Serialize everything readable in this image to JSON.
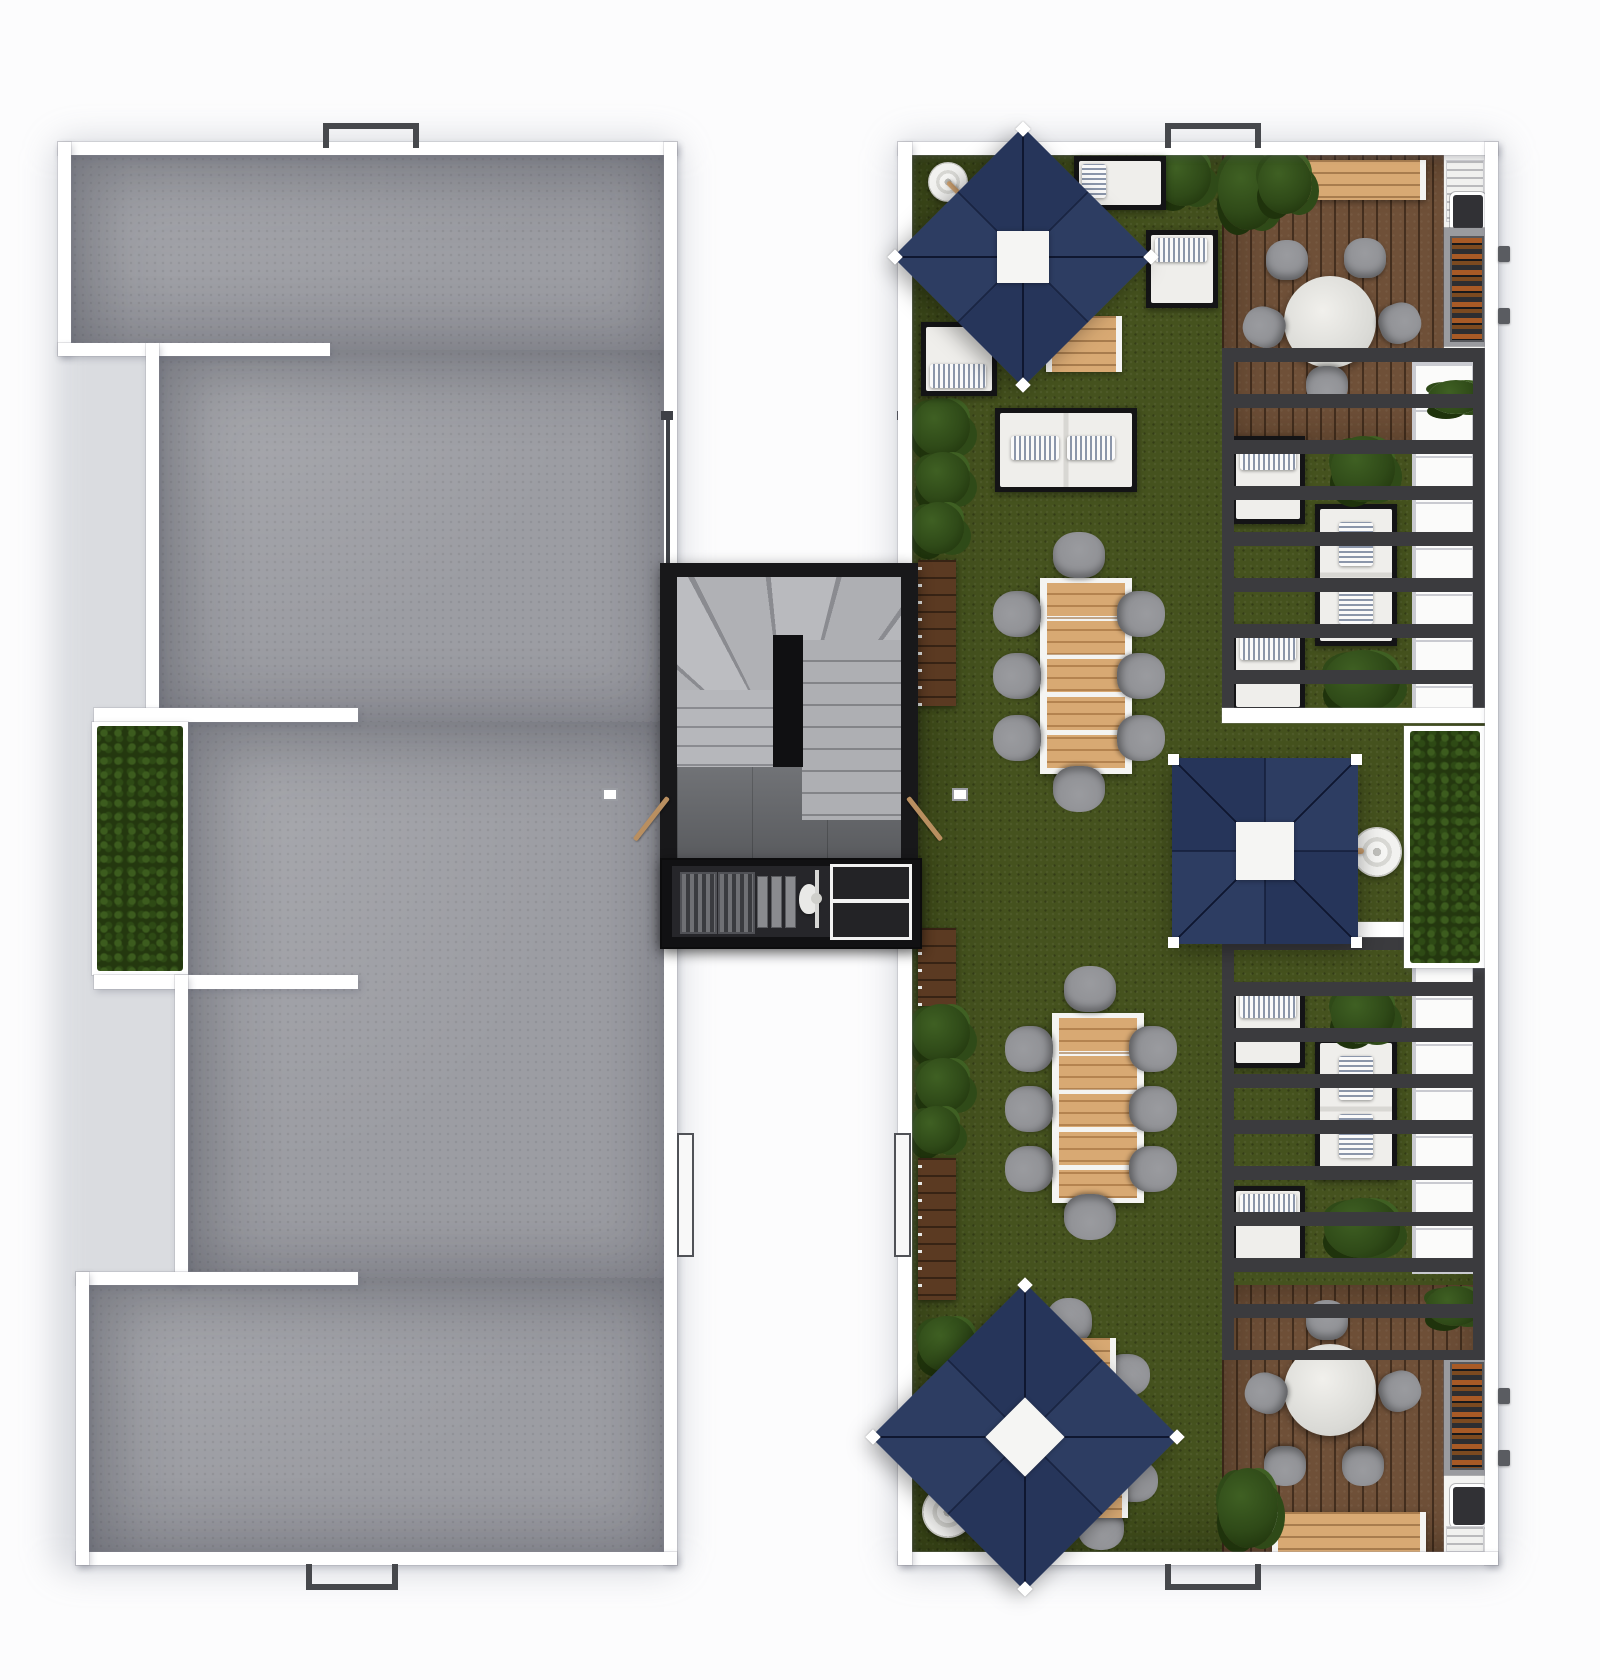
{
  "scene": {
    "type": "architectural-floorplan",
    "subject": "Rooftop terrace level - top-down 3D rendered plan",
    "view": "top-down",
    "background": "#fcfcfd",
    "buildings": [
      {
        "name": "west-roof",
        "description": "Bare concrete roof deck with stepped west facade, a hedge planter recess and roof hatch markers"
      },
      {
        "name": "east-terrace",
        "description": "Landscaped roof terrace with artificial lawn, two pergola lounges, two timber decks with round dining tables and outdoor kitchens, two 8-seat dining tables and three navy patio umbrellas"
      }
    ],
    "connector": "Central stair core with winder staircase, double access doors and a barbecue counter bridging the two roofs, flanked by open light wells with guard railings"
  },
  "palette": {
    "bg": "#fcfcfd",
    "wall": "#ffffff",
    "wall_line": "#c9cad0",
    "concrete": "#9c9da3",
    "grass": "#45521e",
    "shrub_bg": "#24380f",
    "shrub_dot": "#3c5c1e",
    "leaf": "#2f4a18",
    "leaf_hi": "#3f6023",
    "leaf_dk": "#1f330c",
    "deck": "#6f5038",
    "wood_light": "#d8a973",
    "bench_dark": "#5b3a22",
    "navy": "#2d3d62",
    "navy_dark": "#26355a",
    "seam": "#0f1730",
    "pergola": "#3b3b3e",
    "chair": "#8f9094",
    "chair_dark": "#7b7c80",
    "cushion": "#efeeeb",
    "pillow_stripe": "#8b96aa",
    "frame": "#141416",
    "stair_wall": "#18181a",
    "tread": "#b6b7bb",
    "tread_line": "#8a8b90",
    "landing": "#686a6e",
    "counter_white": "#f4f4f2",
    "steel": "#9a9b9f",
    "grill_dark": "#2e2e31",
    "skewer": "#a85a26",
    "hatch": "#46484c",
    "railing": "#3e4046",
    "door_wood": "#b98f60",
    "ring_gray": "#d8d8d4"
  },
  "inventory": {
    "navy_umbrellas": 3,
    "cantilever_umbrella_bases": 3,
    "eight_seat_dining_sets": 2,
    "round_table_five_seat_sets": 2,
    "loose_bistro_chairs": 4,
    "lounge_chairs": 7,
    "outdoor_sofas": 3,
    "dark_wood_wall_benches": 3,
    "light_wood_benches": 2,
    "hedge_planters": 2,
    "plant_clusters": 12,
    "bbq_grill_counters": 3,
    "outdoor_sinks": 3,
    "pergolas": 2,
    "roof_hatch_markers": 4,
    "stair_cores": 1,
    "light_well_railings": 2
  }
}
